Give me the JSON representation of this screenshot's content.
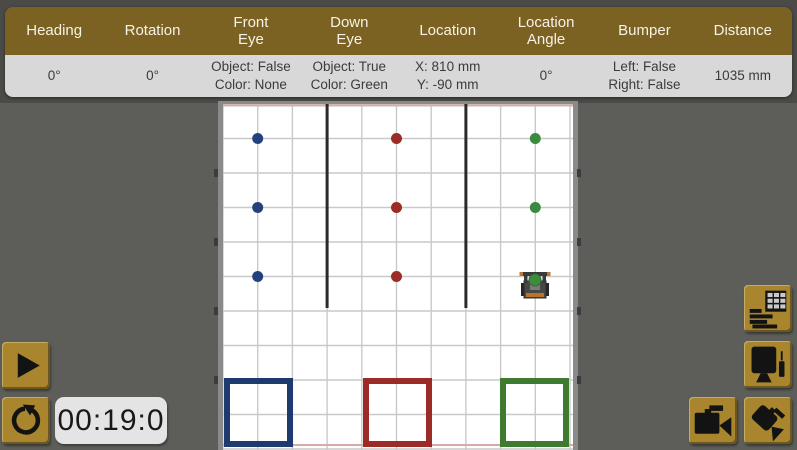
{
  "app": {
    "background": "#5d5d59",
    "top_band_color": "#4a4a47",
    "header_gold": "#7c6222",
    "button_gold": "#a9862e"
  },
  "sensor_bar": {
    "columns": [
      {
        "label": "Heading",
        "value": "0°"
      },
      {
        "label": "Rotation",
        "value": "0°"
      },
      {
        "label": "Front\nEye",
        "value": "Object: False\nColor: None"
      },
      {
        "label": "Down\nEye",
        "value": "Object: True\nColor: Green"
      },
      {
        "label": "Location",
        "value": "X: 810 mm\nY: -90 mm"
      },
      {
        "label": "Location\nAngle",
        "value": "0°"
      },
      {
        "label": "Bumper",
        "value": "Left: False\nRight: False"
      },
      {
        "label": "Distance",
        "value": "1035 mm"
      }
    ]
  },
  "controls": {
    "play_icon": "play-icon",
    "reset_icon": "reset-icon",
    "timer_text": "00:19:0"
  },
  "toolbar": {
    "buttons": [
      {
        "icon": "sensor-dashboard-icon"
      },
      {
        "icon": "monitor-pen-icon"
      },
      {
        "icon": "video-camera-icon"
      },
      {
        "icon": "tilted-camera-icon"
      }
    ]
  },
  "field": {
    "cols": 10,
    "rows": 10,
    "cell_w": 34.7,
    "cell_h": 34.5,
    "width": 350,
    "height": 346,
    "grid_color": "#c9c9c9",
    "wall_color": "#2b2b2b",
    "edge_line_color": "#d8aca4",
    "walls": [
      {
        "col": 3,
        "len": 204
      },
      {
        "col": 7,
        "len": 204
      }
    ],
    "dots": [
      {
        "col": 1,
        "row": 1,
        "color": "#24407d"
      },
      {
        "col": 1,
        "row": 3,
        "color": "#24407d"
      },
      {
        "col": 1,
        "row": 5,
        "color": "#24407d"
      },
      {
        "col": 5,
        "row": 1,
        "color": "#9c2c26"
      },
      {
        "col": 5,
        "row": 3,
        "color": "#9c2c26"
      },
      {
        "col": 5,
        "row": 5,
        "color": "#9c2c26"
      },
      {
        "col": 9,
        "row": 1,
        "color": "#3c8a3d"
      },
      {
        "col": 9,
        "row": 3,
        "color": "#3c8a3d"
      }
    ],
    "goals": [
      {
        "x": 4,
        "color": "#1f3a6e"
      },
      {
        "x": 143,
        "color": "#9c2a26"
      },
      {
        "x": 280,
        "color": "#3e7a30"
      }
    ],
    "goal_y": 277,
    "goal_size": 63,
    "goal_stroke": 6,
    "robot": {
      "x": 312,
      "y": 184,
      "ball_color": "#3f8a3f"
    }
  }
}
